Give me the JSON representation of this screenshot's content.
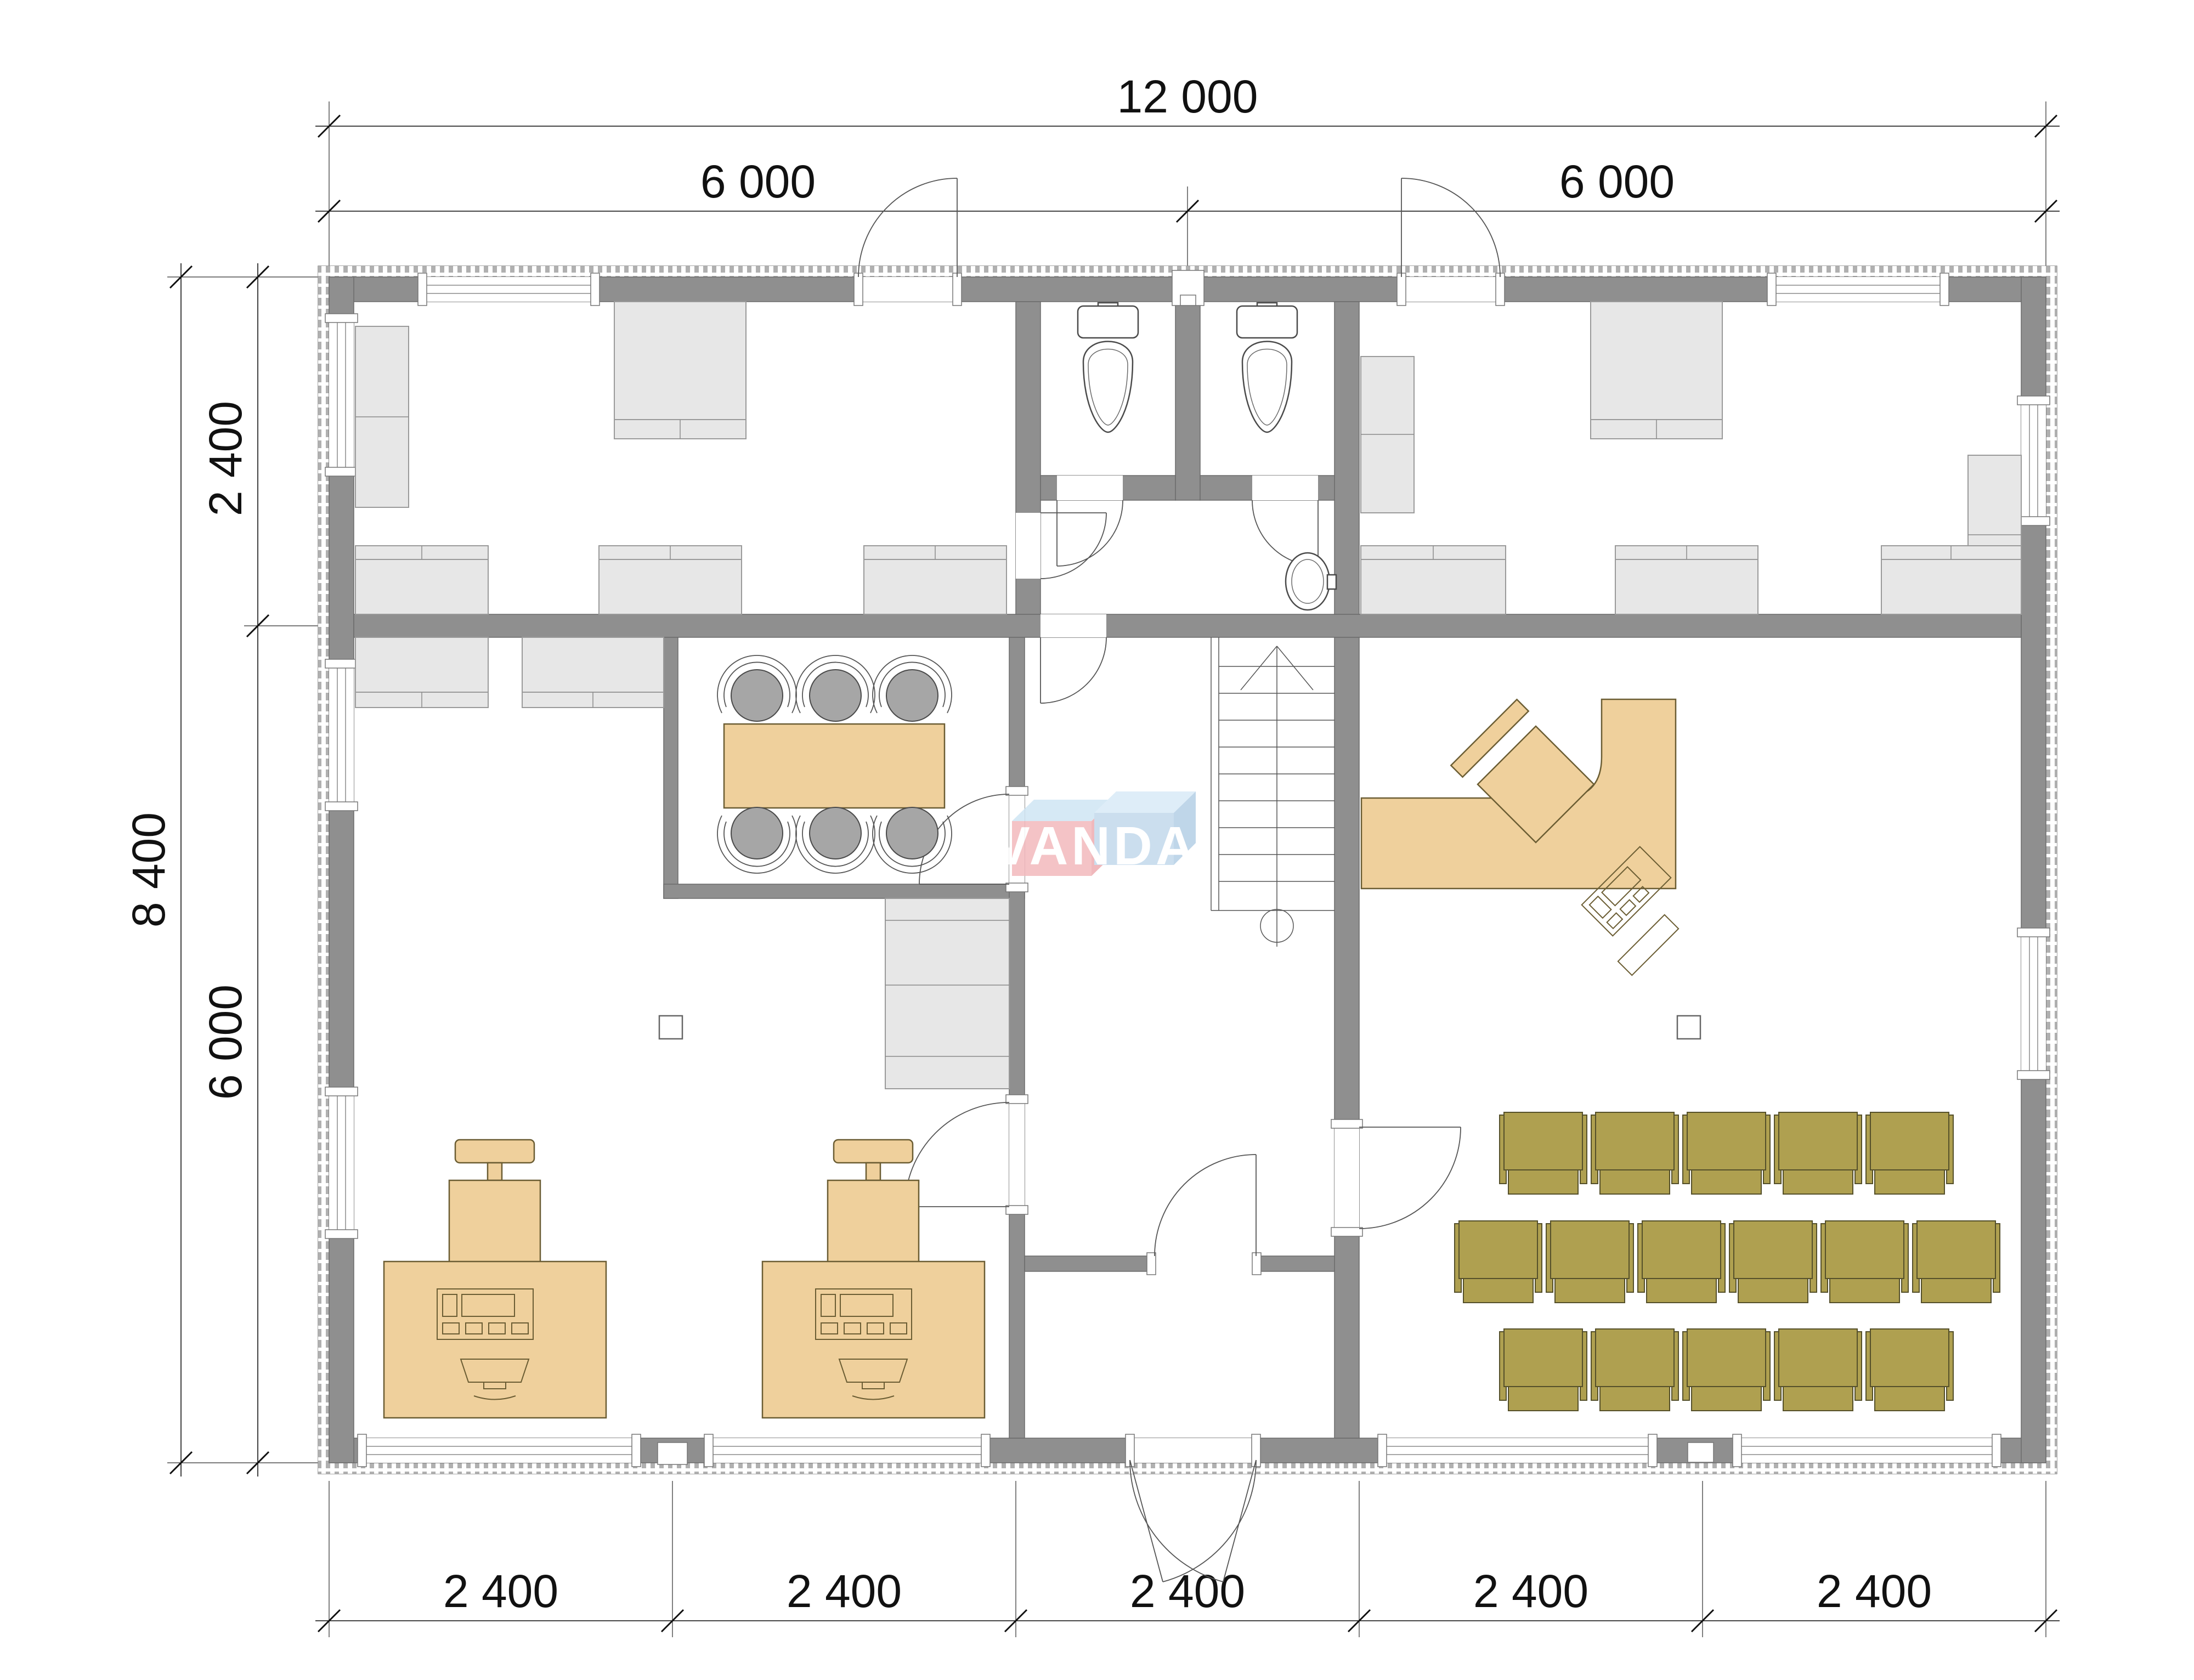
{
  "drawing": {
    "type": "architectural-floor-plan",
    "watermark": {
      "text": "VANDA",
      "box_pink": "#f3b9bd",
      "box_blue": "#c3d9ec",
      "box_top_light": "#d9ebf7"
    },
    "dimensions": {
      "top_total": "12 000",
      "top_left": "6 000",
      "top_right": "6 000",
      "left_total": "8 400",
      "left_top": "2 400",
      "left_bottom": "6 000",
      "bottom": [
        "2 400",
        "2 400",
        "2 400",
        "2 400",
        "2 400"
      ]
    },
    "colors": {
      "wall": "#8f8f8f",
      "furniture_gray": "#e7e7e7",
      "furniture_tan": "#efd09c",
      "furniture_tan_border": "#6b5d33",
      "chair_olive": "#afa050",
      "chair_olive_border": "#55502a",
      "meeting_chair_gray": "#a6a6a6",
      "dimension_text": "#111111"
    }
  }
}
